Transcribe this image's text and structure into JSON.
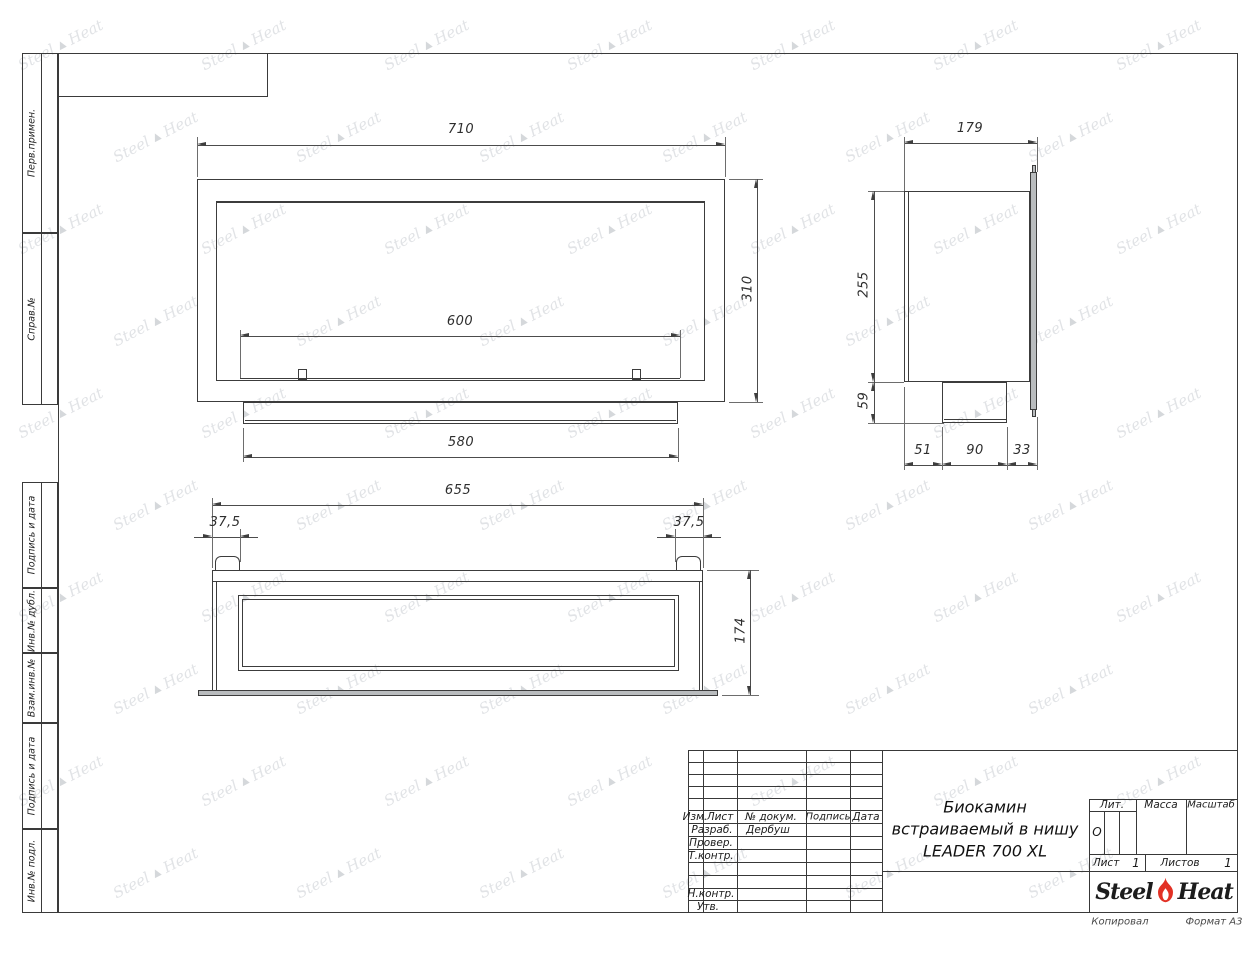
{
  "sheet": {
    "copied_label": "Копировал",
    "format_label": "Формат А3"
  },
  "margin_labels": [
    "Перв.примен.",
    "Справ.№",
    "Подпись и дата",
    "Инв.№ дубл.",
    "Взам.инв.№",
    "Подпись и дата",
    "Инв.№ подл."
  ],
  "title_block": {
    "revision_columns": {
      "izm": "Изм.",
      "list": "Лист",
      "doc": "№ докум.",
      "sign": "Подпись",
      "date": "Дата"
    },
    "roles": {
      "developed": "Разраб.",
      "checked": "Провер.",
      "tcontrol": "Т.контр.",
      "ncontrol": "Н.контр.",
      "approved": "Утв."
    },
    "developed_by": "Дербуш",
    "title_line1": "Биокамин",
    "title_line2": "встраиваемый в нишу",
    "title_line3": "LEADER 700 XL",
    "lit_label": "Лит.",
    "lit_value": "О",
    "mass_label": "Масса",
    "scale_label": "Масштаб",
    "sheet_label": "Лист",
    "sheet_number": "1",
    "sheets_label": "Листов",
    "sheets_total": "1",
    "logo_word1": "Steel",
    "logo_word2": "Heat"
  },
  "watermark": {
    "word1": "Steel",
    "word2": "Heat"
  },
  "dims": {
    "front_width": "710",
    "front_height": "310",
    "burner_width": "600",
    "pedestal_width": "580",
    "side_depth": "179",
    "side_body_height": "255",
    "side_pedestal_height": "59",
    "side_offset_front": "51",
    "side_pedestal_depth": "90",
    "side_offset_back": "33",
    "top_width": "655",
    "top_flange_left": "37,5",
    "top_flange_right": "37,5",
    "top_depth": "174"
  }
}
